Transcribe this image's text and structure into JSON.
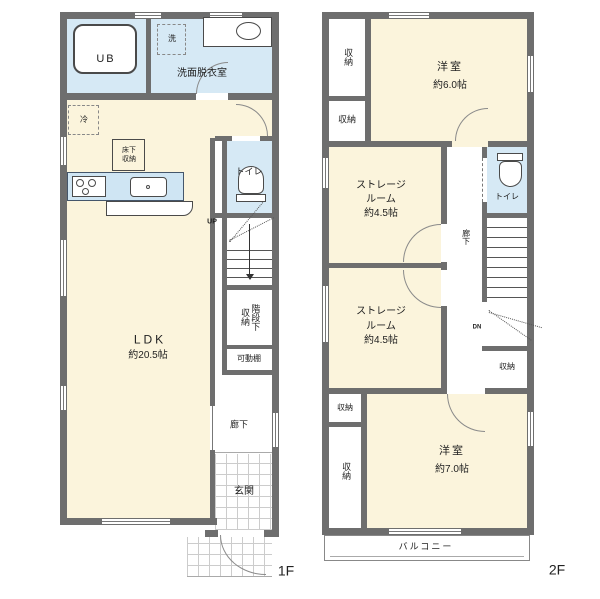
{
  "meta": {
    "colors": {
      "wall": "#6e6e6e",
      "floor": "#fbf4dc",
      "wet_area": "#d6e9f5",
      "background": "#ffffff"
    }
  },
  "f1": {
    "floor_label": "1F",
    "ub": "UB",
    "washroom": "洗面脱衣室",
    "washer": "洗",
    "fridge": "冷",
    "floor_storage": "床下収納",
    "ldk": {
      "name": "LDK",
      "size": "約20.5帖"
    },
    "toilet": "トイレ",
    "up": "UP",
    "stair_storage": "階段下収納",
    "movable_shelf": "可動棚",
    "hallway": "廊下",
    "entrance": "玄関"
  },
  "f2": {
    "floor_label": "2F",
    "closet": "収納",
    "room6": {
      "name": "洋室",
      "size": "約6.0帖"
    },
    "storage1": {
      "l1": "ストレージ",
      "l2": "ルーム",
      "l3": "約4.5帖"
    },
    "storage2": {
      "l1": "ストレージ",
      "l2": "ルーム",
      "l3": "約4.5帖"
    },
    "toilet": "トイレ",
    "hallway": "廊下",
    "dn": "DN",
    "room7": {
      "name": "洋室",
      "size": "約7.0帖"
    },
    "balcony": "バルコニー"
  }
}
